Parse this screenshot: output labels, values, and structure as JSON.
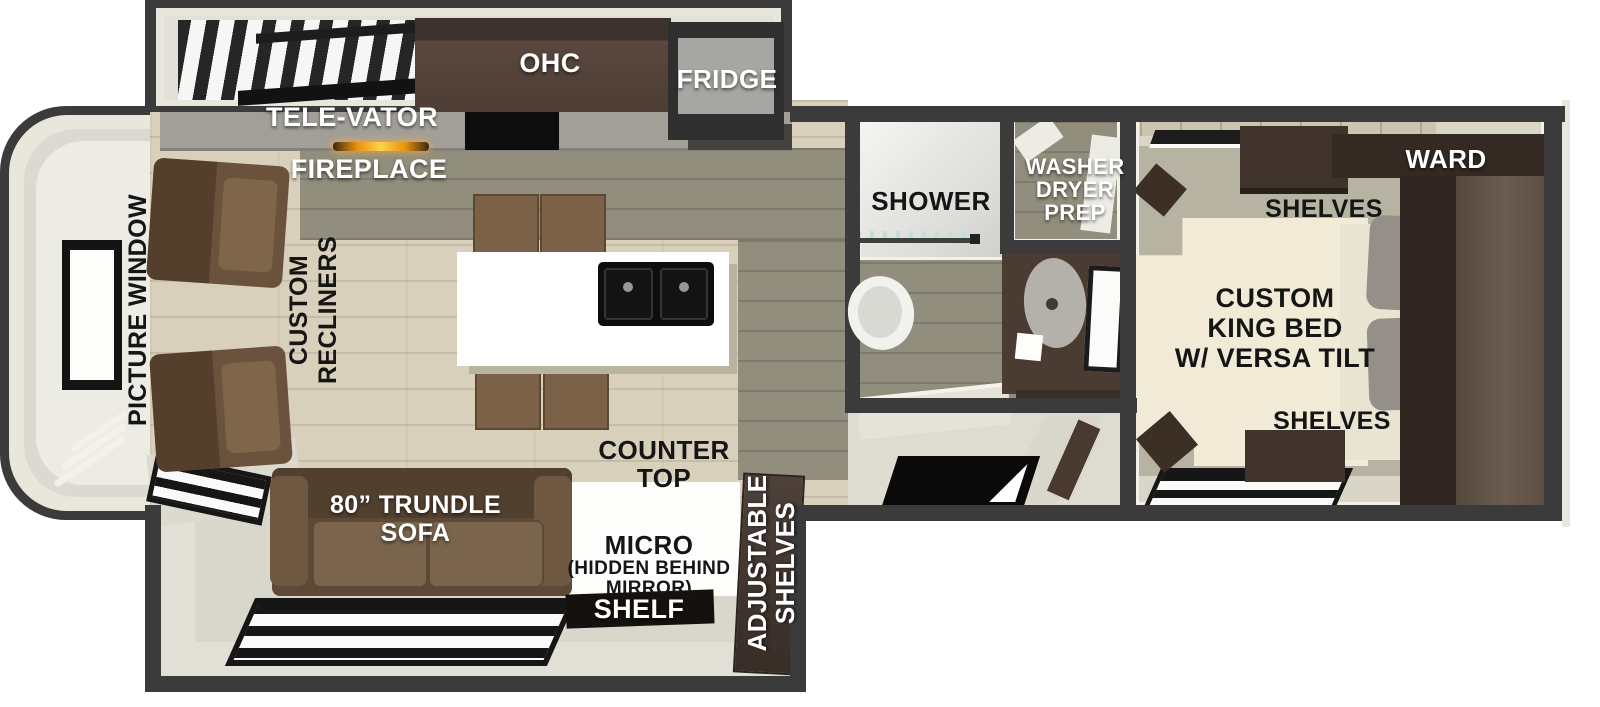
{
  "meta": {
    "title": "RV travel trailer floor plan"
  },
  "colors": {
    "wall": "#3b3b3b",
    "trim": "#e9e6dc",
    "floor-tan": "#d8d0ba",
    "floor-olive": "#918e7d",
    "floor-bedroom": "#b6b3a2",
    "bed-cream": "#f0ead6",
    "wood-dark": "#3f332b",
    "sofa-brown": "#6e5842",
    "chair-brown": "#7a6147",
    "island-white": "#ffffff",
    "counter-gray": "#a19f98",
    "black": "#0d0d0d",
    "fire-orange": "#f5a623",
    "label-white": "#ffffff",
    "label-black": "#151515"
  },
  "floorplan": {
    "kitchen": {
      "ohc": "OHC",
      "fridge": "FRIDGE",
      "televator": "TELE-VATOR",
      "fireplace": "FIREPLACE"
    },
    "living": {
      "picture_window": "PICTURE WINDOW",
      "recliners": [
        "CUSTOM",
        "RECLINERS"
      ],
      "counter_top": [
        "COUNTER",
        "TOP"
      ],
      "sofa": [
        "80” TRUNDLE",
        "SOFA"
      ],
      "micro": "MICRO",
      "micro_note": [
        "(HIDDEN BEHIND",
        "MIRROR)"
      ],
      "shelf": "SHELF",
      "adjustable_shelves": [
        "ADJUSTABLE",
        "SHELVES"
      ]
    },
    "bathroom": {
      "shower": "SHOWER",
      "washer_dryer_prep": [
        "WASHER",
        "DRYER",
        "PREP"
      ]
    },
    "bedroom": {
      "ward": "WARD",
      "shelves_top": "SHELVES",
      "king_bed": [
        "CUSTOM",
        "KING BED",
        "W/ VERSA TILT"
      ],
      "shelves_bottom": "SHELVES"
    }
  }
}
